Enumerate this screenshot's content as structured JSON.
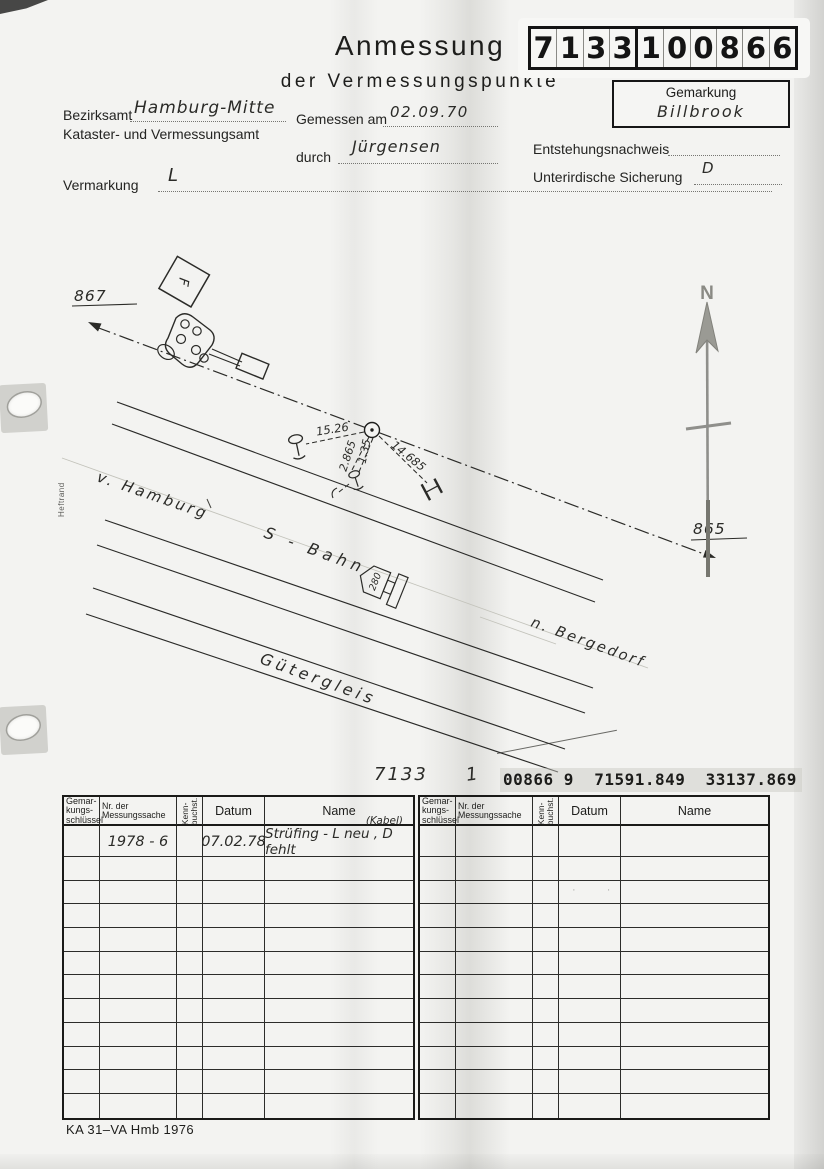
{
  "colors": {
    "paper": "#f3f3f1",
    "ink": "#2b2b28",
    "pencil": "#8a8a86"
  },
  "header": {
    "title_line1": "Anmessung",
    "title_line2": "der Vermessungspunkte",
    "point_number_digits": [
      "7",
      "1",
      "3",
      "3",
      "1",
      "0",
      "0",
      "8",
      "6",
      "6"
    ],
    "gemarkung_label": "Gemarkung",
    "gemarkung_value": "Billbrook"
  },
  "form": {
    "bezirksamt_label": "Bezirksamt",
    "bezirksamt_value": "Hamburg-Mitte",
    "office_line2": "Kataster- und Vermessungsamt",
    "gemessen_am_label": "Gemessen am",
    "gemessen_am_value": "02.09.70",
    "durch_label": "durch",
    "durch_value": "Jürgensen",
    "entstehungsnachweis_label": "Entstehungsnachweis",
    "entstehungsnachweis_value": "",
    "unterirdische_sicherung_label": "Unterirdische Sicherung",
    "unterirdische_sicherung_value": "D",
    "vermarkung_label": "Vermarkung",
    "vermarkung_value": "L"
  },
  "sketch": {
    "point_left": "867",
    "point_right": "865",
    "north_label": "N",
    "margin_label": "Heftrand",
    "label_from": "v. Hamburg",
    "label_line": "S - Bahn",
    "label_to": "n. Bergedorf",
    "label_freight": "Gütergleis",
    "signal_number": "280",
    "f_box_label": "F",
    "measurements": [
      "15.26",
      "2.865",
      "1.35",
      "14.685"
    ]
  },
  "coordinates_line": {
    "sheet": "7133",
    "index": "1",
    "typed": "00866 9  71591.849  33137.869"
  },
  "tables": {
    "header_cells": [
      {
        "lines": [
          "Gemar-",
          "kungs-",
          "schlüssel"
        ],
        "rotated": false
      },
      {
        "lines": [
          "Nr. der",
          "Messungssache"
        ],
        "rotated": false
      },
      {
        "lines": [
          "Kenn-",
          "buchst."
        ],
        "rotated": true
      },
      {
        "lines": [
          "Datum"
        ],
        "rotated": false
      },
      {
        "lines": [
          "Name"
        ],
        "rotated": false
      }
    ],
    "body_row_count": 12,
    "left": {
      "rows": [
        {
          "cells": [
            "",
            "1978 - 6",
            "",
            "07.02.78",
            "Strüfing - L neu , D fehlt"
          ],
          "annotation": "(Kabel)"
        }
      ]
    },
    "right": {
      "rows": []
    }
  },
  "footer": {
    "form_id": "KA 31–VA Hmb 1976"
  }
}
